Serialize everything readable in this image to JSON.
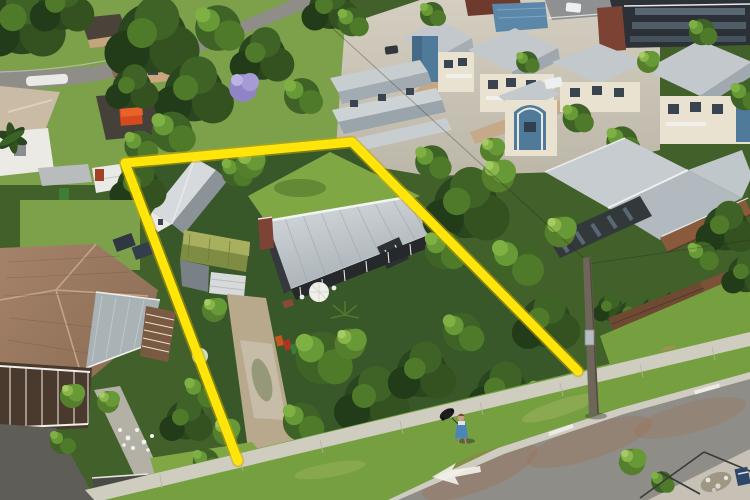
{
  "scene": {
    "type": "aerial-drone-photograph",
    "subject": "single residential property outlined in yellow for a real-estate listing",
    "setting": "leafy coastal suburb: subject cottage with grey metal roof, green-roof garage and barn studio; terracotta-roof neighbour with wraparound veranda; townhouse development behind; street with pedestrian in foreground",
    "visible_text": "none"
  },
  "boundary_overlay": {
    "shape": "open-polyline",
    "stroke_width": 9,
    "color": "#ffe50a",
    "underglow_color": "#c9a800",
    "points": [
      [
        238,
        461
      ],
      [
        125,
        163
      ],
      [
        352,
        142
      ],
      [
        578,
        371
      ]
    ]
  },
  "palette": {
    "boundary_yellow": "#ffe50a",
    "road_asphalt": "#8f8d87",
    "road_rust": "#9c7150",
    "footpath_concrete": "#cfccc0",
    "grass_bright": "#7fa845",
    "grass_verge": "#76a040",
    "foliage_dark": "#243d1c",
    "foliage_mid": "#3f6326",
    "foliage_bright": "#679a37",
    "jacaranda_purple": "#9084c4",
    "subject_roof": "#c3c9cc",
    "subject_wall": "#33383b",
    "garage_roof_green": "#96a050",
    "barn_roof": "#d6dadd",
    "chimney_brick": "#7c4336",
    "left_house_tile": "#9b7b62",
    "veranda_metal": "#a9b2b4",
    "townhouse_wall": "#eae2d0",
    "townhouse_roof": "#c2c8cc",
    "accent_blue_wall": "#4f7a9a",
    "dark_building": "#2c3137",
    "feature_wall_rust": "#7c4335",
    "paving_tan": "#c8a178",
    "driveway_sand": "#b9a98c",
    "person_dress_blue": "#4a86b8",
    "marking_white": "#f2f1ea"
  },
  "landmarks": [
    "yellow property boundary outline",
    "subject cottage with grey corrugated roof, brick chimney, front veranda and white umbrella",
    "moss-green roofed garage with long sandy driveway",
    "grey barn-style studio",
    "neighbour house with terracotta tile roof, solar panels and white veranda railings",
    "modern two-storey glass house with timber deck on the right",
    "cream and blue townhouse development at the rear",
    "street with white lane arrow, centre dashes and concrete footpath",
    "timber power pole at the front boundary corner",
    "pedestrian in blue pushing a dark pram on the road edge",
    "jacaranda tree, dense garden shrubs and large canopies"
  ]
}
